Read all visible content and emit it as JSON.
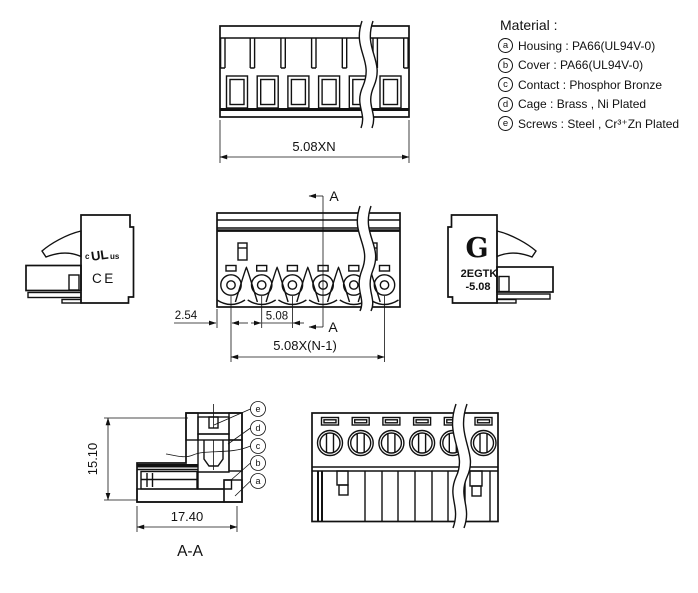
{
  "materials": {
    "title": "Material :",
    "items": [
      {
        "marker": "a",
        "text": "Housing : PA66(UL94V-0)"
      },
      {
        "marker": "b",
        "text": "Cover : PA66(UL94V-0)"
      },
      {
        "marker": "c",
        "text": "Contact : Phosphor Bronze"
      },
      {
        "marker": "d",
        "text": "Cage : Brass , Ni Plated"
      },
      {
        "marker": "e",
        "text": "Screws : Steel , Cr³⁺Zn Plated"
      }
    ]
  },
  "dimensions": {
    "top_width": "5.08XN",
    "offset": "2.54",
    "pitch": "5.08",
    "span": "5.08X(N-1)",
    "height": "15.10",
    "depth": "17.40"
  },
  "section": {
    "label": "A-A",
    "arrow": "A"
  },
  "marks": {
    "ul_c": "c",
    "ul": "UL",
    "ul_us": "us",
    "ce": "CE"
  },
  "brand": {
    "logo": "G",
    "model": "2EGTK",
    "pitch_code": "-5.08"
  },
  "callouts": {
    "e": "e",
    "d": "d",
    "c": "c",
    "b": "b",
    "a": "a"
  },
  "colors": {
    "line": "#111111",
    "background": "#ffffff"
  }
}
